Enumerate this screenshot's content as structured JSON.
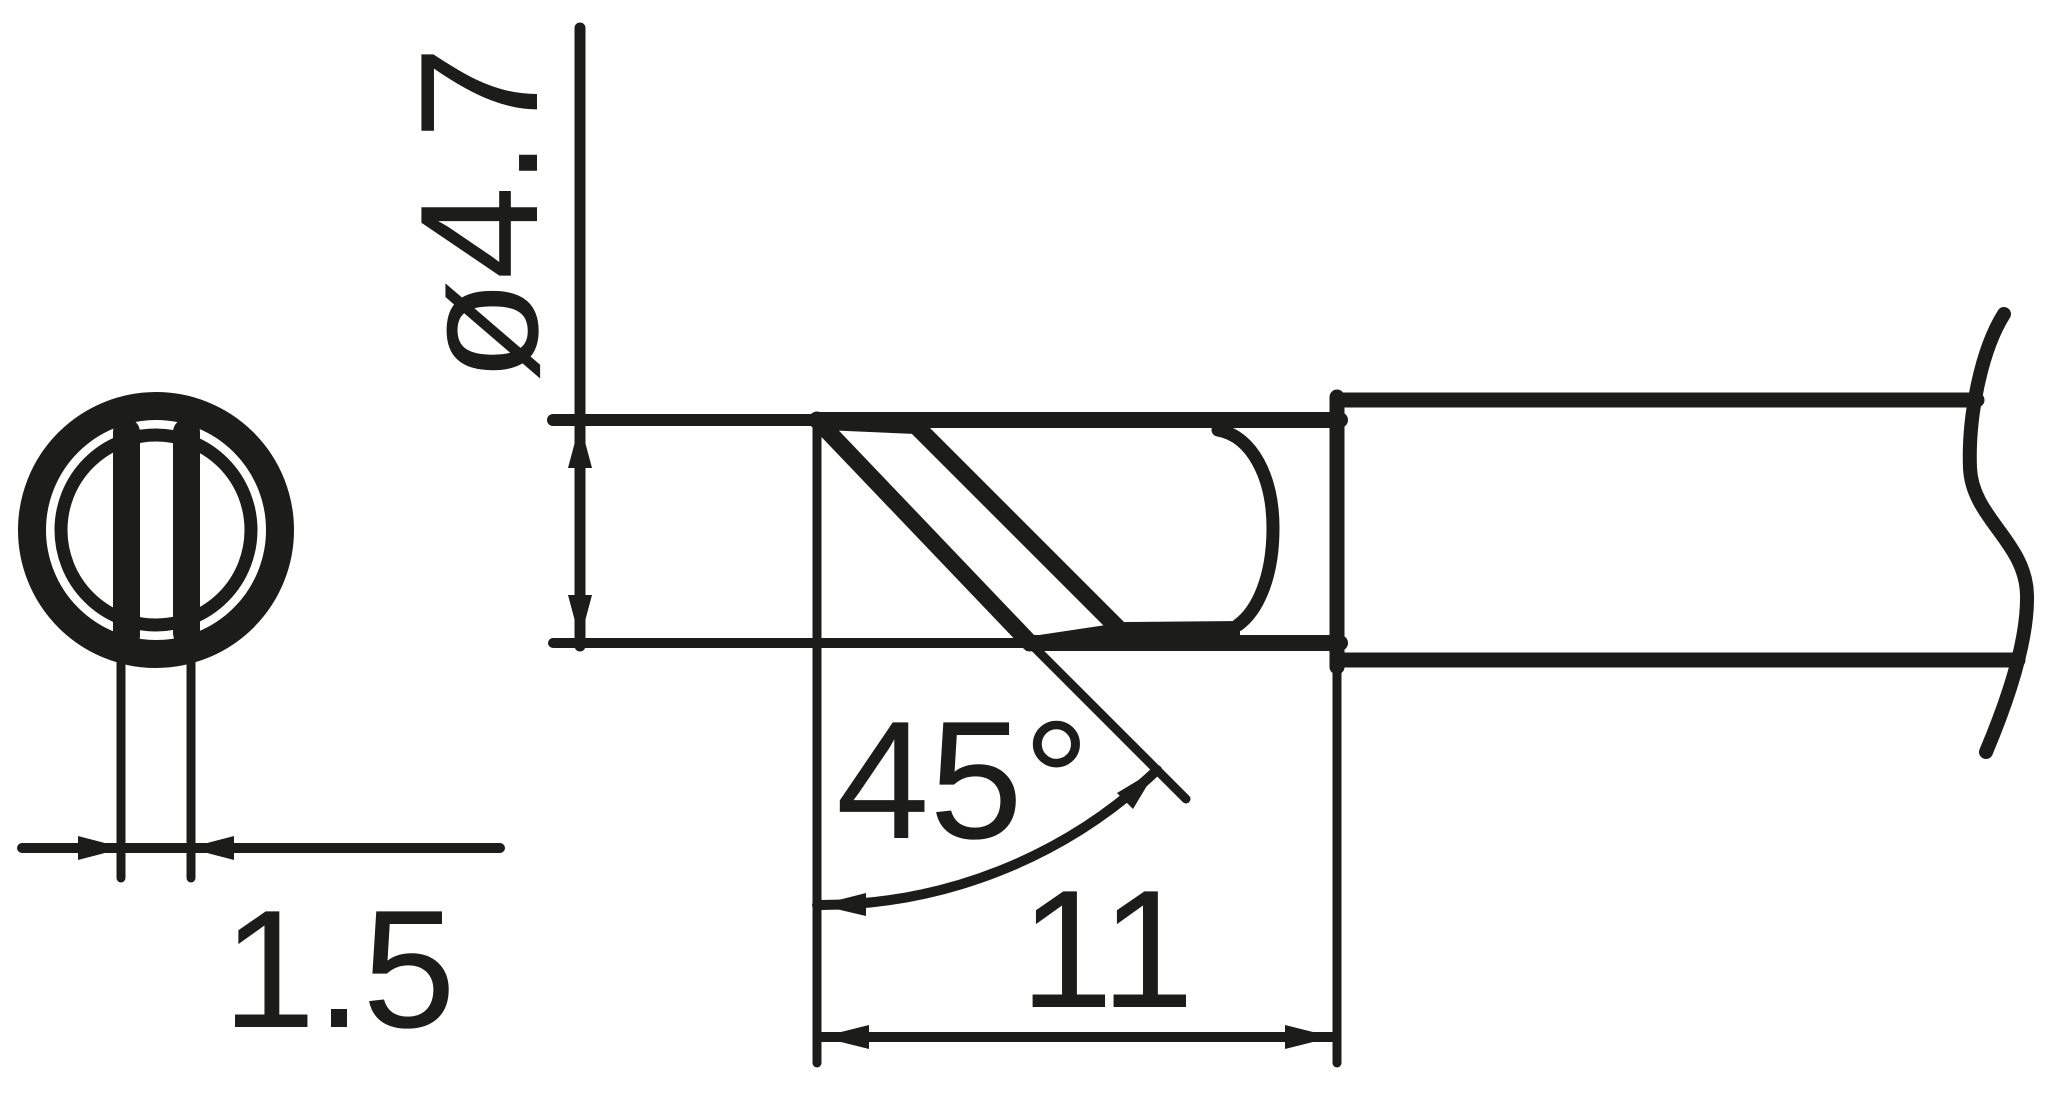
{
  "drawing": {
    "kind": "soldering-tip-dimension-drawing",
    "views": [
      "front-view-circle",
      "side-view-profile"
    ],
    "colors": {
      "line": "#1c1c1a",
      "background": "#ffffff"
    },
    "dimensions": {
      "diameter": {
        "label": "ø4.7",
        "value": 4.7,
        "symbol": "ø"
      },
      "bevel_angle": {
        "label": "45°",
        "value": 45,
        "unit": "deg"
      },
      "tip_length": {
        "label": "11",
        "value": 11
      },
      "flat_width": {
        "label": "1.5",
        "value": 1.5
      }
    }
  }
}
